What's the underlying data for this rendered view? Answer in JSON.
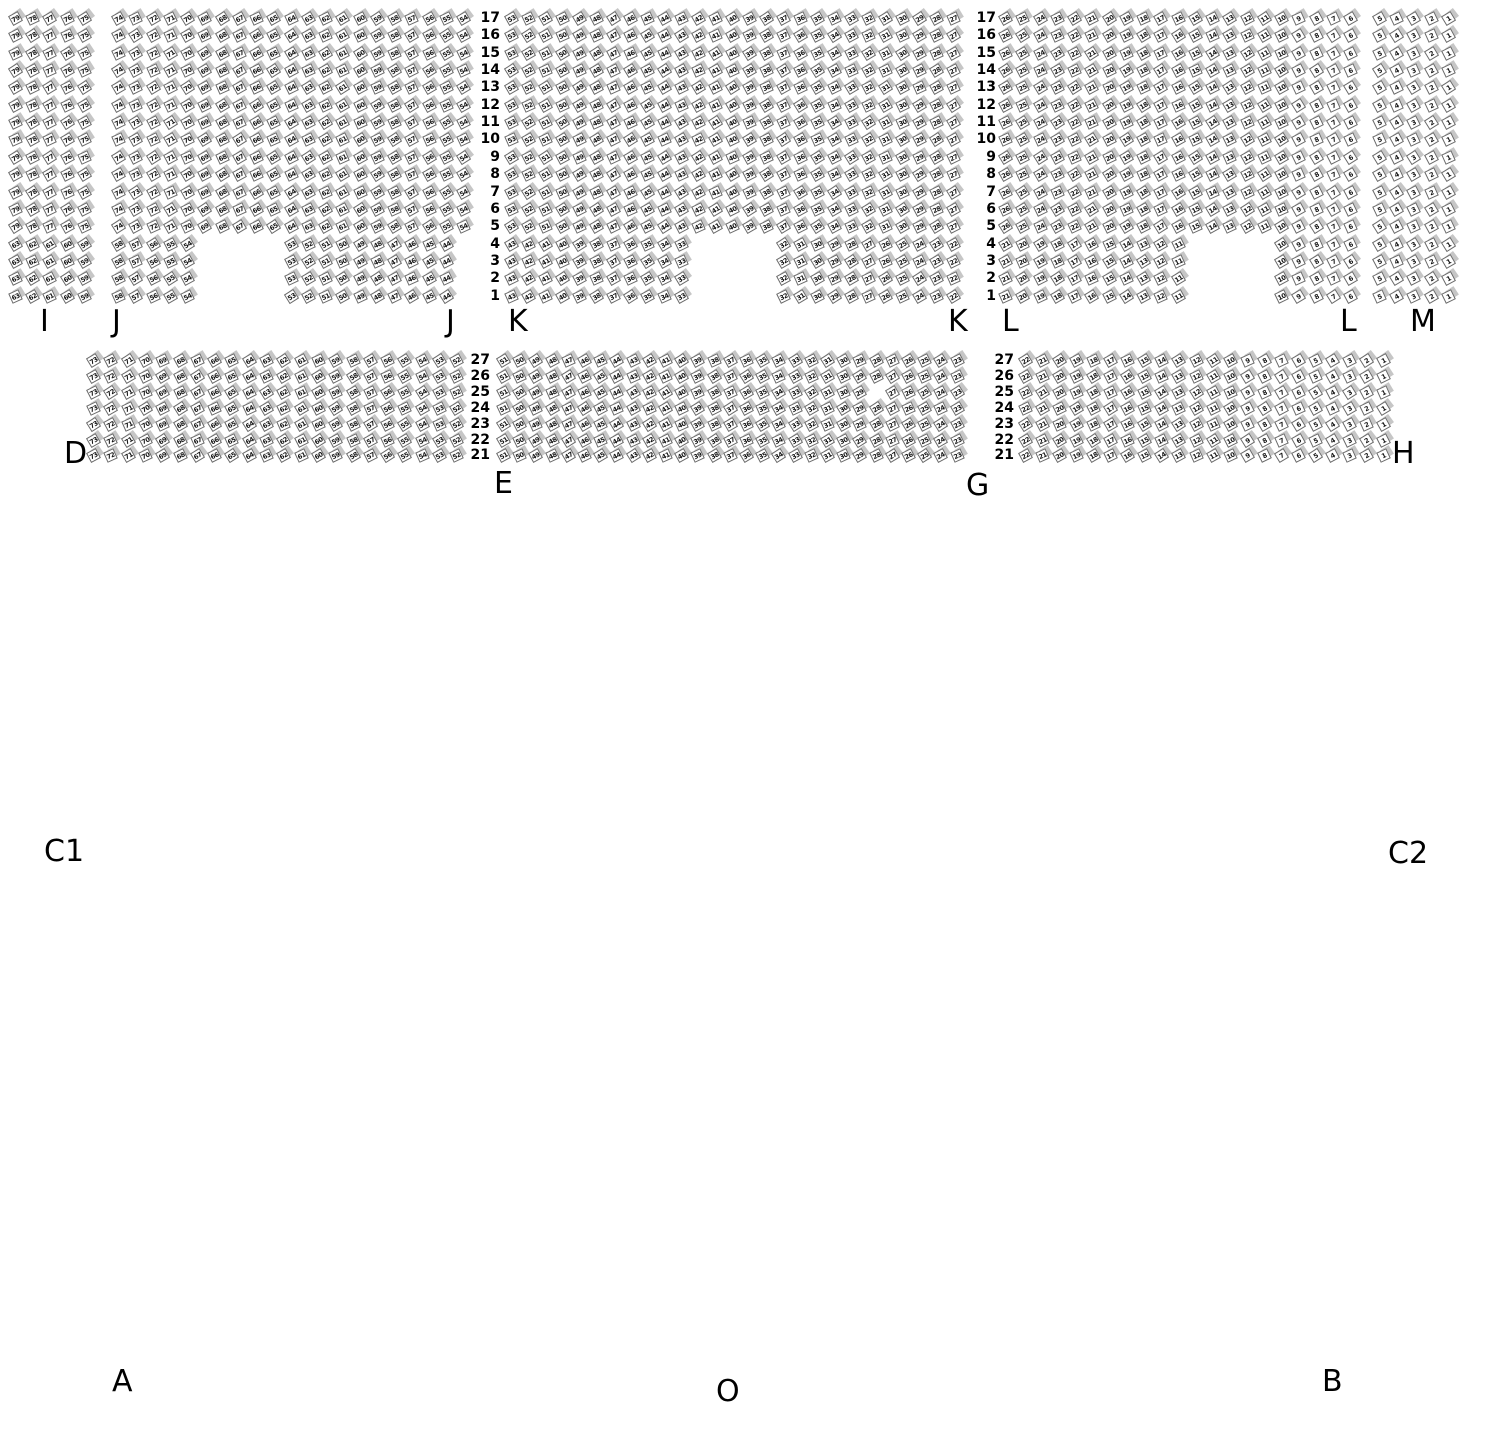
{
  "page": {
    "background": "#ffffff",
    "width": 1490,
    "height": 1430
  },
  "seat_style": {
    "back_color": "#c6c6c6",
    "front_color": "#ffffff",
    "border_color": "#6a6a6a",
    "number_color": "#141414",
    "rotation_deg": -28
  },
  "tiers": [
    {
      "name": "balcony",
      "top_row": 17,
      "y0": 10,
      "row_pitch": 17.35,
      "sections": [
        {
          "id": "I",
          "x0": 10,
          "pitch": 17.2,
          "row_groups": [
            {
              "rows": [
                17,
                5
              ],
              "segments": [
                {
                  "col": 1,
                  "count": 5,
                  "start": 79
                }
              ]
            },
            {
              "rows": [
                4,
                1
              ],
              "segments": [
                {
                  "col": 1,
                  "count": 5,
                  "start": 63
                }
              ]
            }
          ]
        },
        {
          "id": "J",
          "x0": 113,
          "pitch": 17.25,
          "row_groups": [
            {
              "rows": [
                17,
                5
              ],
              "segments": [
                {
                  "col": 1,
                  "count": 21,
                  "start": 74
                }
              ]
            },
            {
              "rows": [
                4,
                1
              ],
              "segments": [
                {
                  "col": 1,
                  "count": 5,
                  "start": 58
                },
                {
                  "col": 11,
                  "count": 10,
                  "start": 53
                }
              ]
            }
          ]
        },
        {
          "id": "K",
          "x0": 506,
          "pitch": 17.0,
          "row_groups": [
            {
              "rows": [
                17,
                5
              ],
              "segments": [
                {
                  "col": 1,
                  "count": 27,
                  "start": 53
                }
              ]
            },
            {
              "rows": [
                4,
                1
              ],
              "segments": [
                {
                  "col": 1,
                  "count": 11,
                  "start": 43
                },
                {
                  "col": 17,
                  "count": 11,
                  "start": 32
                }
              ]
            }
          ]
        },
        {
          "id": "L",
          "x0": 1000,
          "pitch": 17.25,
          "row_groups": [
            {
              "rows": [
                17,
                5
              ],
              "segments": [
                {
                  "col": 1,
                  "count": 21,
                  "start": 26
                }
              ]
            },
            {
              "rows": [
                4,
                1
              ],
              "segments": [
                {
                  "col": 1,
                  "count": 11,
                  "start": 21
                },
                {
                  "col": 17,
                  "count": 5,
                  "start": 10
                }
              ]
            }
          ]
        },
        {
          "id": "M",
          "x0": 1374,
          "pitch": 17.2,
          "row_groups": [
            {
              "rows": [
                17,
                1
              ],
              "segments": [
                {
                  "col": 1,
                  "count": 5,
                  "start": 5
                }
              ]
            }
          ]
        }
      ]
    },
    {
      "name": "mezzanine",
      "top_row": 27,
      "y0": 352,
      "row_pitch": 15.9,
      "sections": [
        {
          "id": "D",
          "x0": 88,
          "pitch": 17.3,
          "row_groups": [
            {
              "rows": [
                27,
                21
              ],
              "segments": [
                {
                  "col": 1,
                  "count": 22,
                  "start": 73
                }
              ]
            }
          ]
        },
        {
          "id": "E",
          "x0": 498,
          "pitch": 16.2,
          "row_groups": [
            {
              "rows": [
                27,
                26
              ],
              "segments": [
                {
                  "col": 1,
                  "count": 29,
                  "start": 51
                }
              ]
            },
            {
              "rows": [
                25,
                25
              ],
              "segments": [
                {
                  "col": 1,
                  "count": 23,
                  "start": 51
                },
                {
                  "col": 25,
                  "count": 5,
                  "start": 27
                }
              ]
            },
            {
              "rows": [
                24,
                21
              ],
              "segments": [
                {
                  "col": 1,
                  "count": 29,
                  "start": 51
                }
              ]
            }
          ]
        },
        {
          "id": "G",
          "x0": 1020,
          "pitch": 17.05,
          "row_groups": [
            {
              "rows": [
                27,
                21
              ],
              "segments": [
                {
                  "col": 1,
                  "count": 22,
                  "start": 22
                }
              ]
            }
          ]
        }
      ]
    }
  ],
  "row_number_columns": [
    {
      "id": "balcony-left",
      "values": [
        17,
        16,
        15,
        14,
        13,
        12,
        11,
        10,
        9,
        8,
        7,
        6,
        5,
        4,
        3,
        2,
        1
      ],
      "right_x": 500,
      "y0": 11,
      "pitch": 17.35
    },
    {
      "id": "balcony-right",
      "values": [
        17,
        16,
        15,
        14,
        13,
        12,
        11,
        10,
        9,
        8,
        7,
        6,
        5,
        4,
        3,
        2,
        1
      ],
      "right_x": 996,
      "y0": 11,
      "pitch": 17.35
    },
    {
      "id": "mezzanine-left",
      "values": [
        27,
        26,
        25,
        24,
        23,
        22,
        21
      ],
      "right_x": 490,
      "y0": 353,
      "pitch": 15.9
    },
    {
      "id": "mezzanine-right",
      "values": [
        27,
        26,
        25,
        24,
        23,
        22,
        21
      ],
      "right_x": 1014,
      "y0": 353,
      "pitch": 15.9
    }
  ],
  "section_labels": [
    {
      "text": "I",
      "x": 40,
      "y": 306
    },
    {
      "text": "J",
      "x": 112,
      "y": 306
    },
    {
      "text": "J",
      "x": 446,
      "y": 306
    },
    {
      "text": "K",
      "x": 508,
      "y": 306
    },
    {
      "text": "K",
      "x": 948,
      "y": 306
    },
    {
      "text": "L",
      "x": 1002,
      "y": 306
    },
    {
      "text": "L",
      "x": 1340,
      "y": 306
    },
    {
      "text": "M",
      "x": 1410,
      "y": 306
    },
    {
      "text": "D",
      "x": 64,
      "y": 438
    },
    {
      "text": "E",
      "x": 494,
      "y": 468
    },
    {
      "text": "G",
      "x": 966,
      "y": 470
    },
    {
      "text": "H",
      "x": 1392,
      "y": 438
    },
    {
      "text": "C1",
      "x": 44,
      "y": 836
    },
    {
      "text": "C2",
      "x": 1388,
      "y": 838
    },
    {
      "text": "A",
      "x": 112,
      "y": 1366
    },
    {
      "text": "O",
      "x": 716,
      "y": 1376
    },
    {
      "text": "B",
      "x": 1322,
      "y": 1366
    }
  ]
}
